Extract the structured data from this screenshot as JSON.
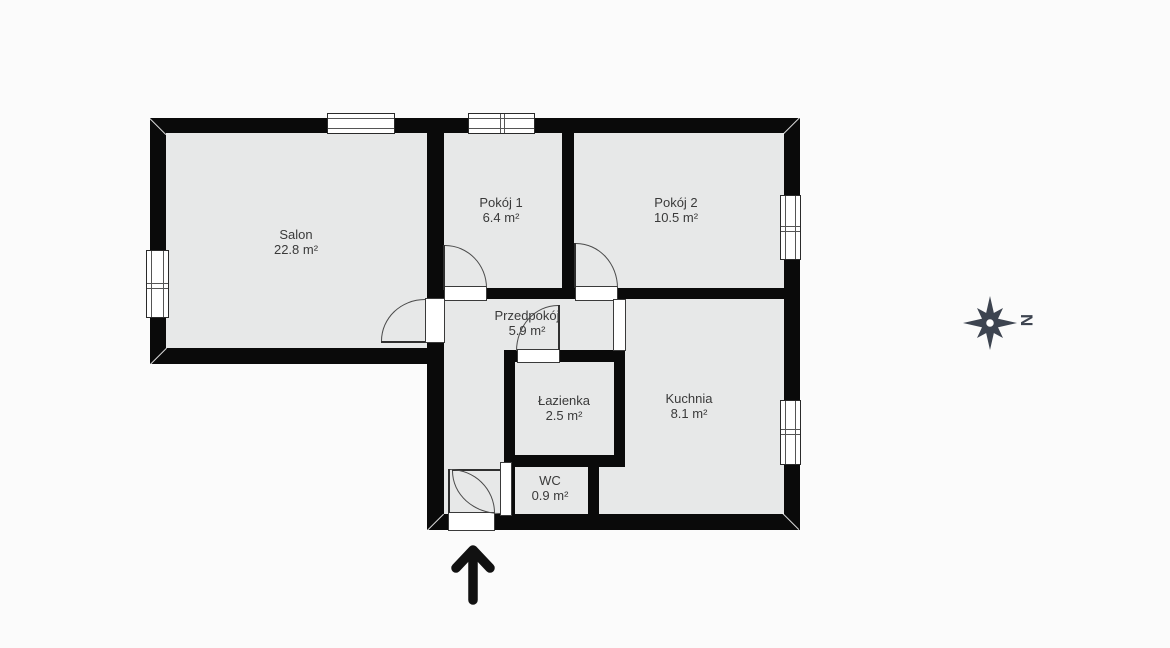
{
  "plan_title": "",
  "rooms": [
    {
      "name": "Salon",
      "area": "22.8 m²"
    },
    {
      "name": "Pokój 1",
      "area": "6.4 m²"
    },
    {
      "name": "Pokój 2",
      "area": "10.5 m²"
    },
    {
      "name": "Przedpokój",
      "area": "5.9 m²"
    },
    {
      "name": "Łazienka",
      "area": "2.5 m²"
    },
    {
      "name": "Kuchnia",
      "area": "8.1 m²"
    },
    {
      "name": "WC",
      "area": "0.9 m²"
    }
  ],
  "compass": {
    "north_label": "N"
  },
  "colors": {
    "wall": "#0a0a0a",
    "room_fill": "#e7e8e8",
    "door_window_line": "#3a3a3a",
    "label_text": "#3a3a3a",
    "compass": "#3d4450",
    "background": "#fbfbfb"
  }
}
